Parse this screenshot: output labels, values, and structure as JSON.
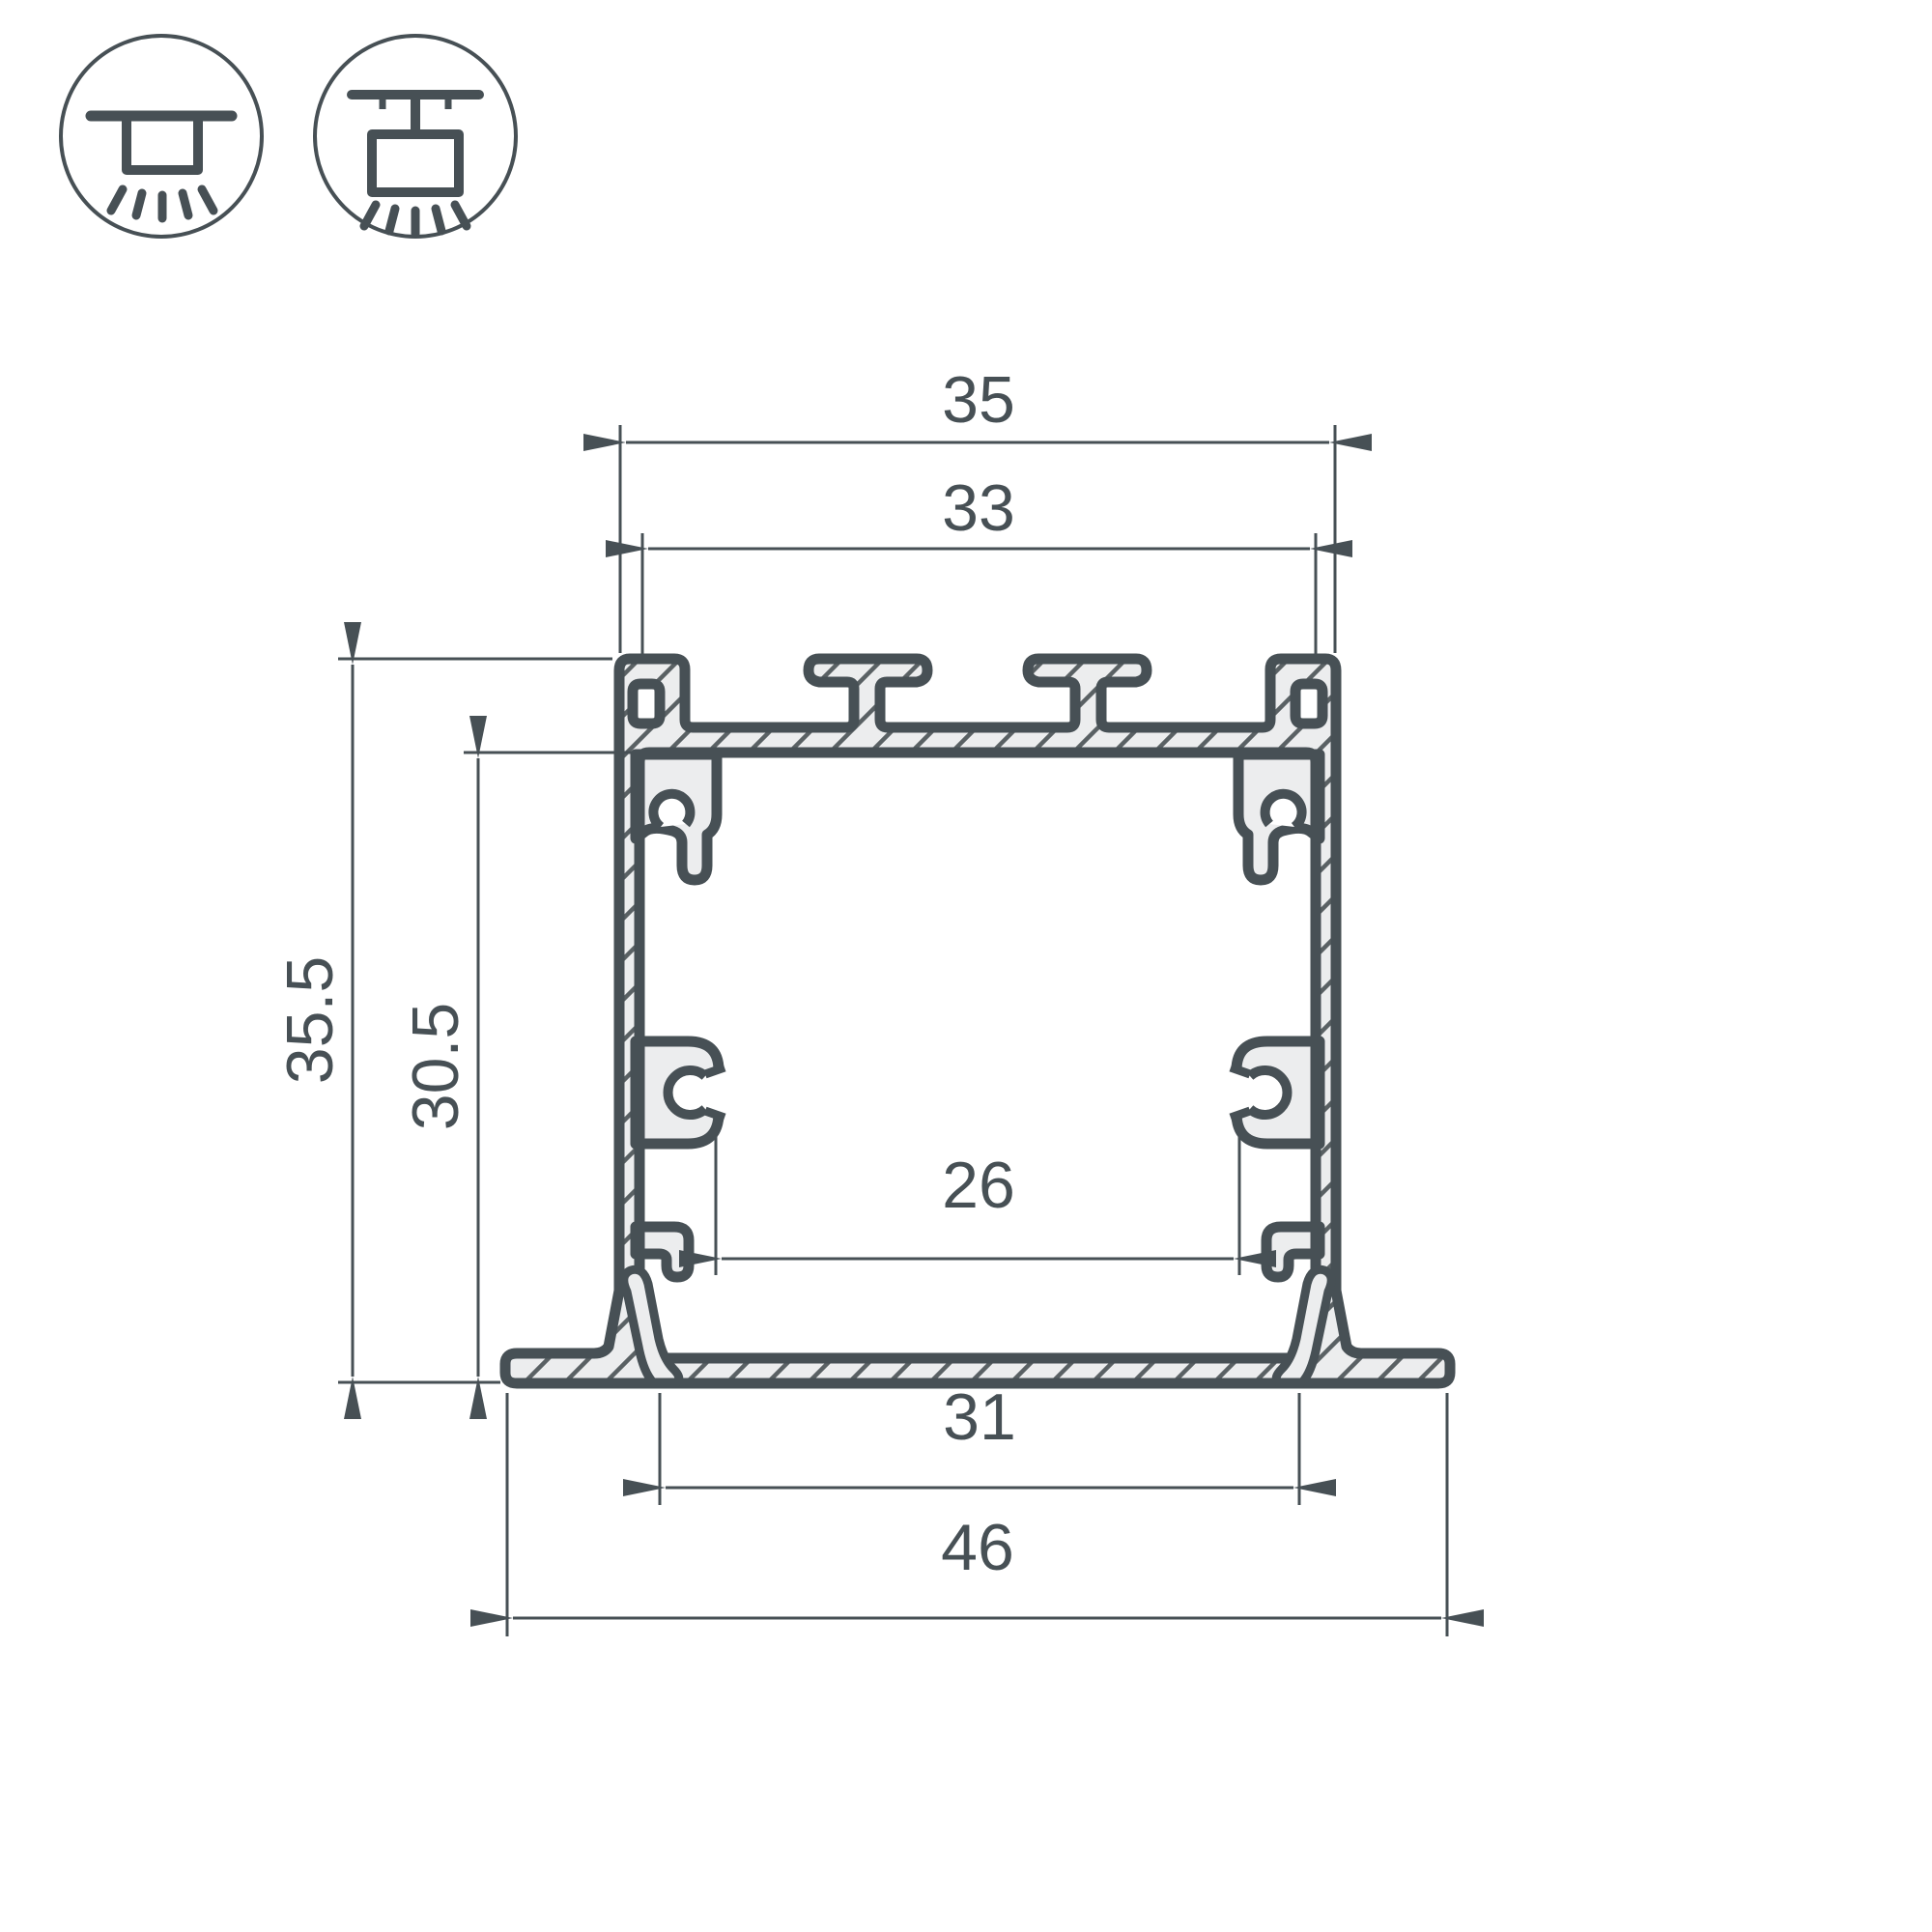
{
  "meta": {
    "title": "Aluminium LED profile cross-section technical drawing"
  },
  "palette": {
    "line": "#475055",
    "metal_fill": "#ecedee",
    "hatch": "#5a6164",
    "background": "#ffffff"
  },
  "icons": [
    {
      "name": "recessed-mount-icon"
    },
    {
      "name": "surface-mount-icon"
    }
  ],
  "dimensions": {
    "top_width": "35",
    "slot_width": "33",
    "height": "35.5",
    "inner_height": "30.5",
    "inner_width": "26",
    "base_inner_width": "31",
    "flange_width": "46"
  }
}
